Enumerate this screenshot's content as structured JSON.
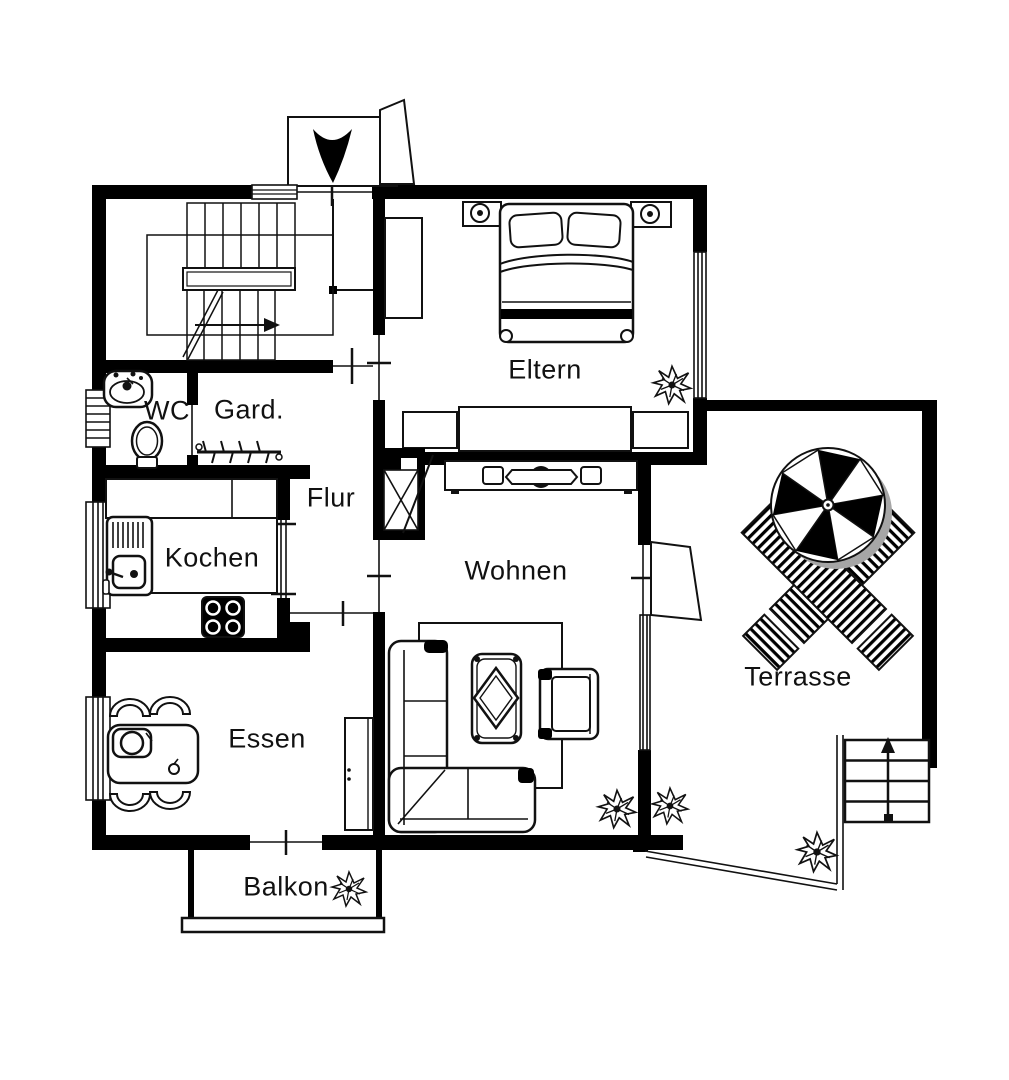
{
  "plan": {
    "type": "floor-plan",
    "style": "black-and-white architectural drawing"
  },
  "rooms": {
    "wc": {
      "label": "WC"
    },
    "garderobe": {
      "label": "Gard."
    },
    "flur": {
      "label": "Flur"
    },
    "kochen": {
      "label": "Kochen"
    },
    "eltern": {
      "label": "Eltern"
    },
    "wohnen": {
      "label": "Wohnen"
    },
    "essen": {
      "label": "Essen"
    },
    "balkon": {
      "label": "Balkon"
    },
    "terrasse": {
      "label": "Terrasse"
    }
  },
  "colors": {
    "wall": "#000000",
    "floor": "#ffffff",
    "line": "#111111",
    "shadow": "#a6a6a6"
  },
  "icons": [
    "staircase-icon",
    "entrance-arrow-icon",
    "canopy-icon",
    "wc-sink-icon",
    "toilet-icon",
    "coat-rack-icon",
    "kitchen-sink-icon",
    "stove-icon",
    "counter-icon",
    "double-bed-icon",
    "nightstand-lamp-icon",
    "wardrobe-icon",
    "dresser-icon",
    "tv-sideboard-icon",
    "fireplace-icon",
    "sofa-icon",
    "coffee-table-icon",
    "armchair-icon",
    "rug-icon",
    "dining-table-icon",
    "chair-icon",
    "cabinet-icon",
    "plant-icon",
    "parasol-icon",
    "sun-lounger-icon",
    "outdoor-stairs-icon",
    "railing-icon",
    "window-icon",
    "door-icon"
  ]
}
